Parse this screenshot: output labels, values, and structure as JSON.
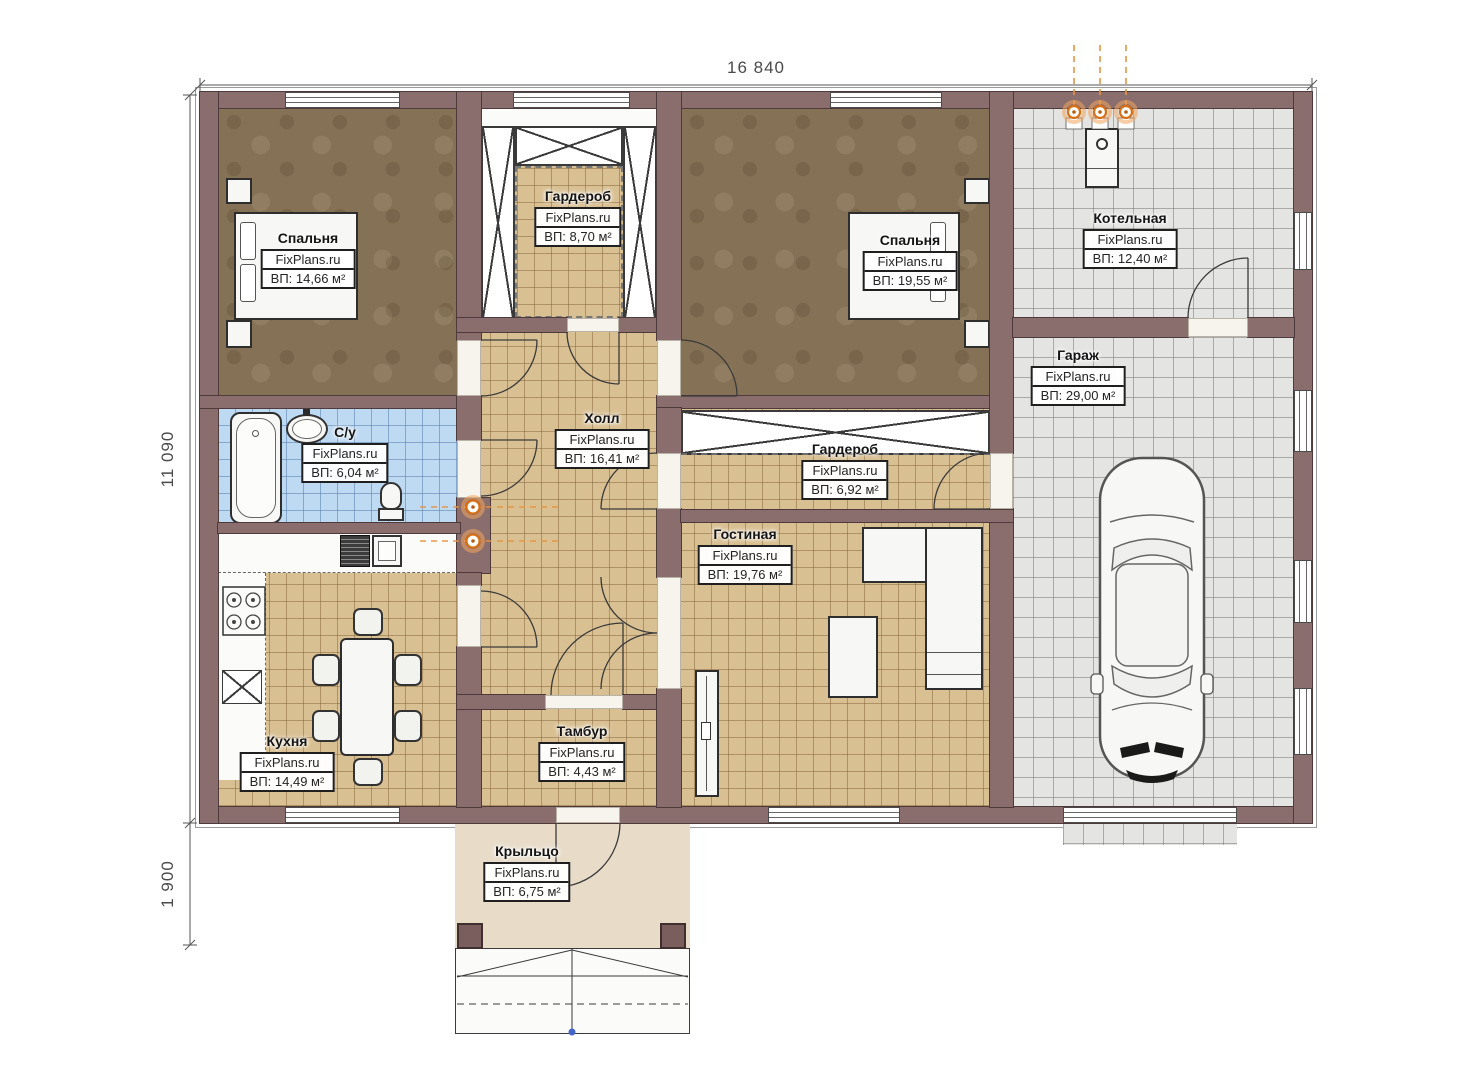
{
  "plan": {
    "title": "Одноэтажный план дома",
    "watermark": "FixPlans.ru",
    "rooms": [
      {
        "name": "Спальня",
        "area": "ВП: 14,66 м²"
      },
      {
        "name": "Гардероб",
        "area": "ВП: 8,70 м²"
      },
      {
        "name": "Спальня",
        "area": "ВП: 19,55 м²"
      },
      {
        "name": "Котельная",
        "area": "ВП: 12,40 м²"
      },
      {
        "name": "Гараж",
        "area": "ВП: 29,00 м²"
      },
      {
        "name": "С/у",
        "area": "ВП: 6,04 м²"
      },
      {
        "name": "Холл",
        "area": "ВП: 16,41 м²"
      },
      {
        "name": "Гардероб",
        "area": "ВП: 6,92 м²"
      },
      {
        "name": "Гостиная",
        "area": "ВП: 19,76 м²"
      },
      {
        "name": "Кухня",
        "area": "ВП: 14,49 м²"
      },
      {
        "name": "Тамбур",
        "area": "ВП: 4,43 м²"
      },
      {
        "name": "Крыльцо",
        "area": "ВП: 6,75 м²"
      }
    ],
    "dimensions": {
      "width": "16 840",
      "height": "11 090",
      "porch_depth": "1 900"
    },
    "colors": {
      "wall": "#8a6e6e",
      "tile_floor": "#d9c093",
      "bathroom_tile": "#bed9f2",
      "garage_tile": "#e4e4e3",
      "bedroom_floor": "#857155",
      "porch_floor": "#e8dcc9",
      "accent_orange": "#e07818"
    },
    "icons": [
      "car-icon",
      "bathtub-icon",
      "sink-icon",
      "toilet-icon",
      "stove-icon",
      "boiler-icon",
      "chimney-flue-icon",
      "vent-duct-icon",
      "bed-icon",
      "sofa-icon"
    ]
  }
}
